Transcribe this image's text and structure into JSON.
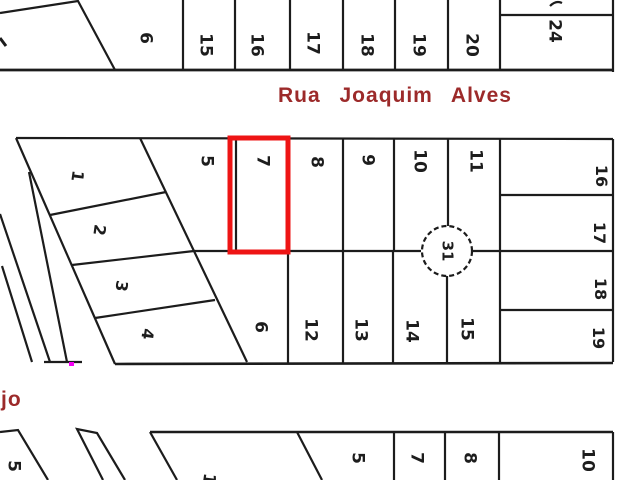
{
  "window": {
    "width": 640,
    "height": 480,
    "app": "plat-map-view"
  },
  "streets": {
    "top": "Rua Joaquim Alves",
    "left_partial": "jo"
  },
  "block": {
    "number": "31",
    "cx": 447,
    "cy": 251,
    "r": 25
  },
  "highlight": {
    "lot": "7",
    "x": 230,
    "y": 138,
    "w": 58,
    "h": 114
  },
  "colors": {
    "line": "#1c1c1c",
    "street_text": "#9c2a2a",
    "highlight_red": "#ee1414",
    "stray_dot_magenta": "#f400f4",
    "background": "#ffffff"
  },
  "labels": [
    {
      "group": "top-block",
      "text": "6",
      "x": 145,
      "y": 38,
      "rot": 90,
      "size": 17
    },
    {
      "group": "top-block",
      "text": "15",
      "x": 205,
      "y": 45,
      "rot": 90,
      "size": 17
    },
    {
      "group": "top-block",
      "text": "16",
      "x": 256,
      "y": 45,
      "rot": 90,
      "size": 17
    },
    {
      "group": "top-block",
      "text": "17",
      "x": 312,
      "y": 43,
      "rot": 90,
      "size": 17
    },
    {
      "group": "top-block",
      "text": "18",
      "x": 366,
      "y": 45,
      "rot": 90,
      "size": 17
    },
    {
      "group": "top-block",
      "text": "19",
      "x": 418,
      "y": 45,
      "rot": 90,
      "size": 17
    },
    {
      "group": "top-block",
      "text": "20",
      "x": 471,
      "y": 45,
      "rot": 90,
      "size": 17
    },
    {
      "group": "top-block",
      "text": "24",
      "x": 554,
      "y": 31,
      "rot": 90,
      "size": 17
    },
    {
      "group": "main-block",
      "text": "1",
      "x": 77,
      "y": 176,
      "rot": 98,
      "size": 16
    },
    {
      "group": "main-block",
      "text": "2",
      "x": 99,
      "y": 230,
      "rot": 98,
      "size": 16
    },
    {
      "group": "main-block",
      "text": "3",
      "x": 121,
      "y": 286,
      "rot": 98,
      "size": 16
    },
    {
      "group": "main-block",
      "text": "4",
      "x": 147,
      "y": 334,
      "rot": 98,
      "size": 16
    },
    {
      "group": "main-block",
      "text": "5",
      "x": 206,
      "y": 161,
      "rot": 90,
      "size": 17
    },
    {
      "group": "main-block",
      "text": "7",
      "x": 262,
      "y": 161,
      "rot": 90,
      "size": 17
    },
    {
      "group": "main-block",
      "text": "8",
      "x": 316,
      "y": 162,
      "rot": 90,
      "size": 17
    },
    {
      "group": "main-block",
      "text": "9",
      "x": 367,
      "y": 160,
      "rot": 90,
      "size": 17
    },
    {
      "group": "main-block",
      "text": "10",
      "x": 419,
      "y": 161,
      "rot": 90,
      "size": 17
    },
    {
      "group": "main-block",
      "text": "11",
      "x": 475,
      "y": 161,
      "rot": 90,
      "size": 17
    },
    {
      "group": "main-block",
      "text": "6",
      "x": 260,
      "y": 327,
      "rot": 90,
      "size": 17
    },
    {
      "group": "main-block",
      "text": "12",
      "x": 310,
      "y": 330,
      "rot": 90,
      "size": 17
    },
    {
      "group": "main-block",
      "text": "13",
      "x": 360,
      "y": 330,
      "rot": 90,
      "size": 17
    },
    {
      "group": "main-block",
      "text": "14",
      "x": 411,
      "y": 331,
      "rot": 90,
      "size": 17
    },
    {
      "group": "main-block",
      "text": "15",
      "x": 466,
      "y": 329,
      "rot": 90,
      "size": 17
    },
    {
      "group": "main-block",
      "text": "16",
      "x": 601,
      "y": 176,
      "rot": 90,
      "size": 16
    },
    {
      "group": "main-block",
      "text": "17",
      "x": 599,
      "y": 233,
      "rot": 90,
      "size": 16
    },
    {
      "group": "main-block",
      "text": "18",
      "x": 600,
      "y": 289,
      "rot": 90,
      "size": 16
    },
    {
      "group": "main-block",
      "text": "19",
      "x": 598,
      "y": 338,
      "rot": 90,
      "size": 16
    },
    {
      "group": "block-number",
      "text": "31",
      "x": 447,
      "y": 251,
      "rot": 90,
      "size": 15
    },
    {
      "group": "bottom-block",
      "text": "5",
      "x": 13,
      "y": 466,
      "rot": 90,
      "size": 17
    },
    {
      "group": "bottom-block",
      "text": "1",
      "x": 208,
      "y": 479,
      "rot": 98,
      "size": 17
    },
    {
      "group": "bottom-block",
      "text": "5",
      "x": 357,
      "y": 458,
      "rot": 90,
      "size": 17
    },
    {
      "group": "bottom-block",
      "text": "7",
      "x": 416,
      "y": 458,
      "rot": 90,
      "size": 17
    },
    {
      "group": "bottom-block",
      "text": "8",
      "x": 469,
      "y": 458,
      "rot": 90,
      "size": 17
    },
    {
      "group": "bottom-block",
      "text": "10",
      "x": 587,
      "y": 460,
      "rot": 90,
      "size": 17
    }
  ]
}
